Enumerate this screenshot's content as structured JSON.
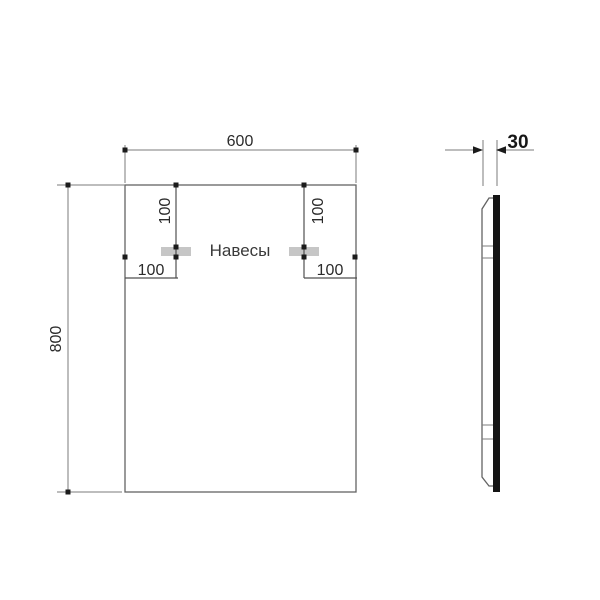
{
  "labels": {
    "front_width": "600",
    "front_height": "800",
    "left_bracket_vertical_offset": "100",
    "right_bracket_vertical_offset": "100",
    "left_bracket_horizontal_offset": "100",
    "right_bracket_horizontal_offset": "100",
    "brackets_caption": "Навесы",
    "side_thickness": "30"
  },
  "colors": {
    "outline": "#636363",
    "dimension_line": "#7b7b7b",
    "text": "#2b2b2b",
    "marker": "#1b1b1b",
    "bracket_fill": "#c6c6c6",
    "glass_profile": "#141414",
    "background": "#ffffff"
  }
}
